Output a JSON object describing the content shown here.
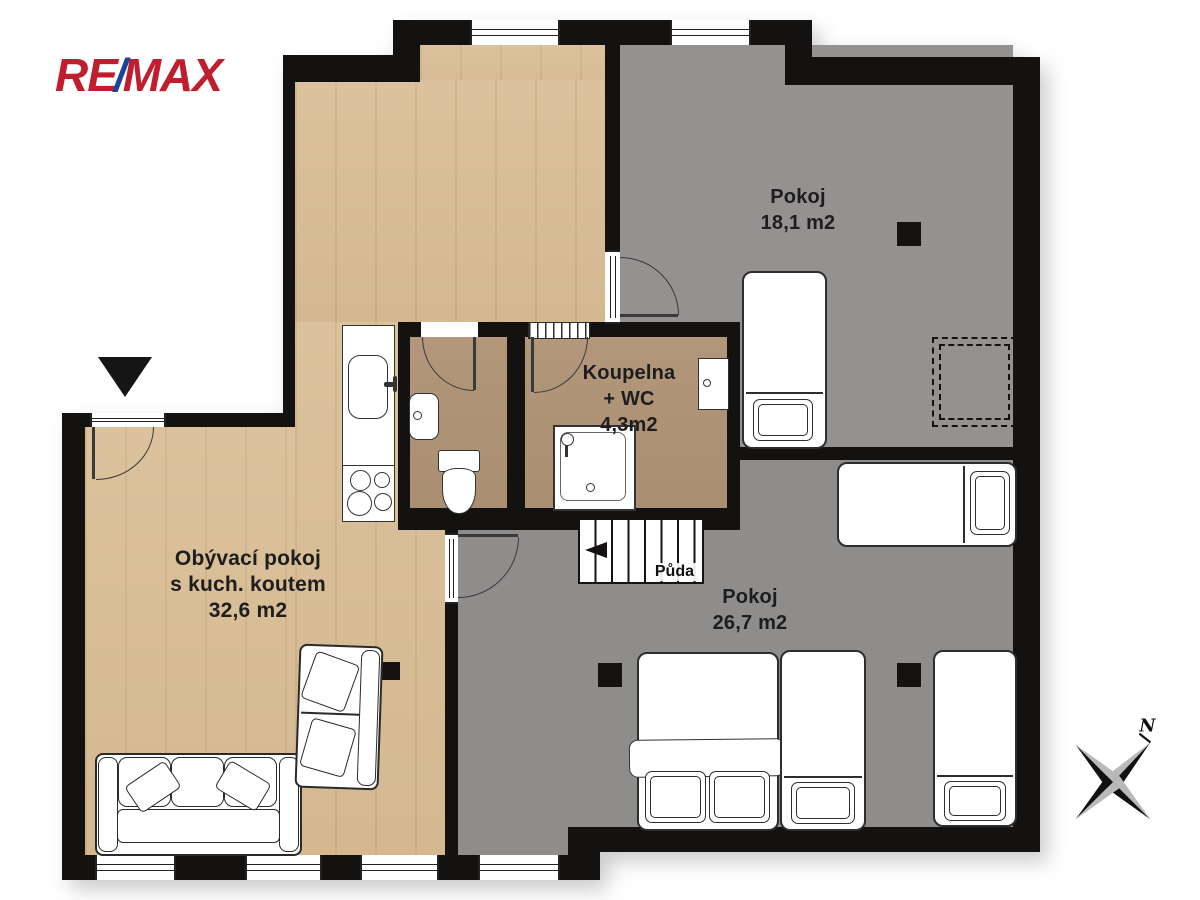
{
  "logo": {
    "re": "RE",
    "slash": "/",
    "max": "MAX"
  },
  "colors": {
    "logo_red": "#c01d2e",
    "logo_blue": "#1c4596",
    "wall": "#131211",
    "wood": "#dcc29c",
    "tile": "#b2977b",
    "gray_room": "#949190",
    "gray_room_2": "#8f8c8c",
    "label_text": "#1d1d1d"
  },
  "rooms": {
    "living": {
      "line1": "Obývací pokoj",
      "line2": "s kuch. koutem",
      "area": "32,6 m2"
    },
    "bedroom_top": {
      "name": "Pokoj",
      "area": "18,1 m2"
    },
    "bedroom_bottom": {
      "name": "Pokoj",
      "area": "26,7 m2"
    },
    "bathroom": {
      "line1": "Koupelna",
      "line2": "+ WC",
      "area": "4,3m2"
    },
    "stairs_label": "Půda"
  },
  "compass": {
    "north_label": "N"
  },
  "icons": {
    "entrance_marker": "filled triangle pointing down",
    "compass": "four-point star",
    "window": "double-pane lines"
  }
}
